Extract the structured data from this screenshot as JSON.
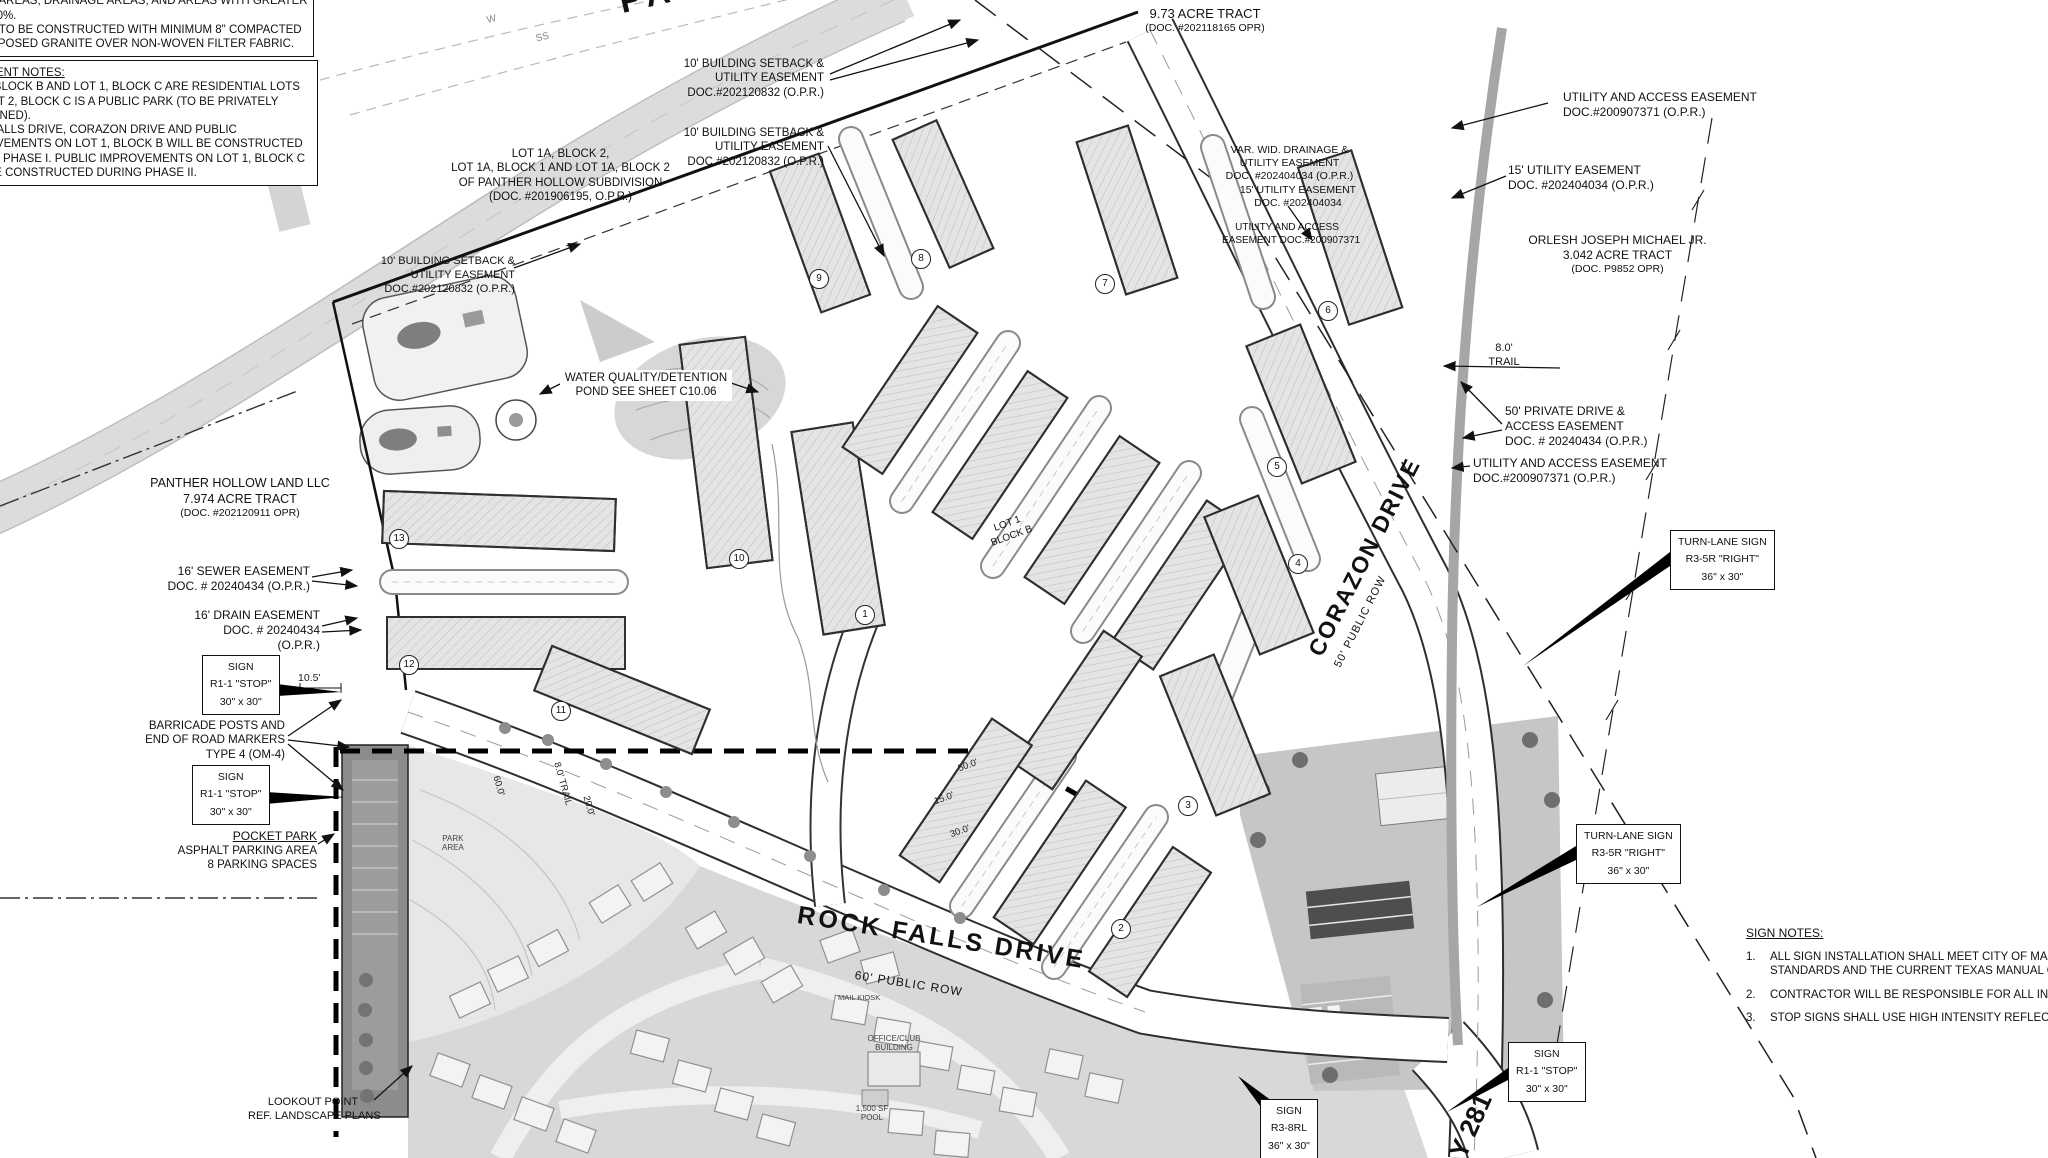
{
  "street_names": {
    "panther_partial": "PANTHE",
    "rock_falls": "ROCK FALLS DRIVE",
    "rock_falls_row": "60' PUBLIC ROW",
    "corazon": "CORAZON DRIVE",
    "corazon_row": "50' PUBLIC ROW",
    "hwy_partial": "Y 281"
  },
  "notes_box1": {
    "clipped_line": "CRETE IS TO BE INCORPORATED ON TRAILS WITHOUT",
    "lines": [
      "ONE AREAS, DRAINAGE AREAS, AND AREAS WITH GREATER",
      "AN 10%.",
      "AILS TO BE CONSTRUCTED WITH MINIMUM 8\" COMPACTED",
      "COMPOSED GRANITE OVER NON-WOVEN FILTER FABRIC."
    ]
  },
  "notes_box2": {
    "title": "VEMENT NOTES:",
    "lines": [
      "T 1, BLOCK B AND LOT 1, BLOCK C ARE RESIDENTIAL LOTS",
      "D LOT 2, BLOCK C IS A PUBLIC PARK (TO BE PRIVATELY",
      "INTAINED).",
      "CK FALLS DRIVE, CORAZON DRIVE AND PUBLIC",
      "PROVEMENTS ON LOT 1, BLOCK B WILL BE CONSTRUCTED",
      "RING PHASE I.  PUBLIC IMPROVEMENTS ON LOT 1, BLOCK C",
      "LL BE CONSTRUCTED DURING PHASE II."
    ]
  },
  "tracts": {
    "north": [
      "9.73 ACRE TRACT",
      "(DOC. #202118165 OPR)"
    ],
    "east": [
      "ORLESH JOSEPH MICHAEL JR.",
      "3.042 ACRE TRACT",
      "(DOC. P9852 OPR)"
    ],
    "west": [
      "PANTHER HOLLOW LAND LLC",
      "7.974 ACRE TRACT",
      "(DOC. #202120911 OPR)"
    ],
    "subdivision": [
      "LOT 1A, BLOCK 2,",
      "LOT 1A, BLOCK 1 AND LOT 1A, BLOCK 2",
      "OF PANTHER HOLLOW SUBDIVISION",
      "(DOC. #201906195, O.P.R.)"
    ]
  },
  "easements": {
    "setback_ne": [
      "10' BUILDING SETBACK &",
      "UTILITY EASEMENT",
      "DOC.#202120832 (O.P.R.)"
    ],
    "setback_n": [
      "10' BUILDING SETBACK &",
      "UTILITY EASEMENT",
      "DOC.#202120832 (O.P.R.)"
    ],
    "setback_w": [
      "10' BUILDING SETBACK &",
      "UTILITY EASEMENT",
      "DOC.#202120832 (O.P.R.)"
    ],
    "utility_access_ne": [
      "UTILITY AND ACCESS EASEMENT",
      "DOC.#200907371 (O.P.R.)"
    ],
    "utility_15_ne": [
      "15' UTILITY EASEMENT",
      "DOC. #202404034 (O.P.R.)"
    ],
    "trail_width": "8.0'",
    "trail_word": "TRAIL",
    "private_drive": [
      "50' PRIVATE DRIVE &",
      "ACCESS EASEMENT",
      "DOC.  # 20240434 (O.P.R.)"
    ],
    "utility_access_e": [
      "UTILITY AND ACCESS EASEMENT",
      "DOC.#200907371 (O.P.R.)"
    ],
    "sewer_16": [
      "16' SEWER EASEMENT",
      "DOC. # 20240434 (O.P.R.)"
    ],
    "drain_16": [
      "16' DRAIN EASEMENT",
      "DOC.  # 20240434",
      "(O.P.R.)"
    ],
    "drainage_var": [
      "VAR. WID. DRAINAGE &",
      "UTILITY EASEMENT",
      "DOC. #202404034 (O.P.R.)"
    ],
    "utility_15_mid": [
      "15' UTILITY EASEMENT",
      "DOC. #202404034"
    ],
    "utility_access_mid": [
      "UTILITY AND ACCESS",
      "EASEMENT DOC.#200907371"
    ]
  },
  "signs": {
    "stop": [
      "SIGN",
      "R1-1 \"STOP\"",
      "30\" x 30\""
    ],
    "turn_lane": [
      "TURN-LANE SIGN",
      "R3-5R \"RIGHT\"",
      "36\" x 30\""
    ],
    "r3_8rl": [
      "SIGN",
      "R3-8RL",
      "36\" x 30\""
    ]
  },
  "sign_notes": {
    "title": "SIGN NOTES:",
    "n1": "1.",
    "n2": "2.",
    "n3": "3.",
    "item1a": "ALL SIGN INSTALLATION SHALL MEET CITY OF MARBLE FAL",
    "item1b": "STANDARDS AND THE CURRENT TEXAS MANUAL OF UNIFO",
    "item2": "CONTRACTOR WILL BE RESPONSIBLE FOR ALL INSPECTIO",
    "item3": "STOP SIGNS SHALL USE HIGH INTENSITY REFLECTIVE SHE"
  },
  "features": {
    "water_quality": [
      "WATER QUALITY/DETENTION",
      "POND SEE SHEET C10.06"
    ],
    "barricade": [
      "BARRICADE POSTS AND",
      "END OF ROAD MARKERS",
      "TYPE 4 (OM-4)"
    ],
    "pocket_park_title": "POCKET PARK",
    "pocket_park": [
      "ASPHALT PARKING AREA",
      "8 PARKING SPACES"
    ],
    "lookout": [
      "LOOKOUT POINT",
      "REF. LANDSCAPE PLANS"
    ],
    "park_area": [
      "PARK",
      "AREA"
    ],
    "mail_kiosk": "MAIL KIOSK",
    "office_club": [
      "OFFICE/CLUB",
      "BUILDING"
    ],
    "pool": [
      "1,500 SF",
      "POOL"
    ],
    "lot1": [
      "LOT 1",
      "BLOCK B"
    ]
  },
  "dims": {
    "d105": "10.5'",
    "d60": "60.0'",
    "d20": "20.0'",
    "trail_w": "8.0' TRAIL",
    "d50": "50.0'",
    "d15": "15.0'",
    "d30": "30.0'"
  },
  "utilities": {
    "ss": "SS",
    "w": "W"
  },
  "building_numbers": [
    "1",
    "2",
    "3",
    "4",
    "5",
    "6",
    "7",
    "8",
    "9",
    "10",
    "11",
    "12",
    "13"
  ]
}
